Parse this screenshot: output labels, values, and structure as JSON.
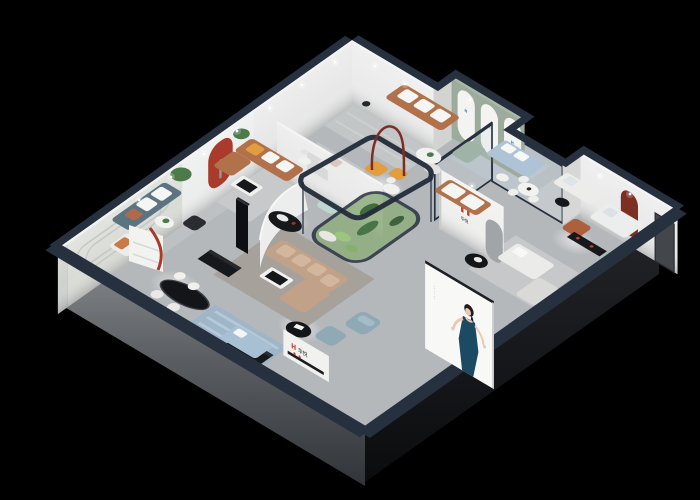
{
  "scene": {
    "title": "Furniture showroom 3D isometric cutaway render",
    "background": "#000000"
  },
  "colors": {
    "background": "#000000",
    "navy": "#27303f",
    "floor": "#b5b8bb",
    "wall": "#e9eaea",
    "sage": "#9cab9b",
    "brand_red": "#cf3b2e",
    "accent_red": "#a93b2c",
    "dark_red": "#7e2f23",
    "caramel": "#b0714b",
    "tan": "#c2a189",
    "slate": "#5c7382",
    "leather_blue": "#8fa9b5",
    "mint": "#bcd8cf",
    "orange": "#e39c3f",
    "plant": "#4c7a49",
    "rug_blue": "#9fb6c9",
    "poster_dress": "#1d4a63",
    "black_furniture": "#17181b"
  },
  "signage": {
    "wall_logo": {
      "mark": "H",
      "name": "华悦"
    },
    "reception_sign": {
      "mark": "H",
      "name": "华悦"
    },
    "gallery_wall_text": "· · · · · ·",
    "niche_wall_text": "· · · ·",
    "poster_side_text": "· · · · · ·",
    "arch_panels": [
      {
        "mark": "H"
      },
      {
        "mark": "H"
      },
      {
        "mark": "H"
      }
    ]
  }
}
